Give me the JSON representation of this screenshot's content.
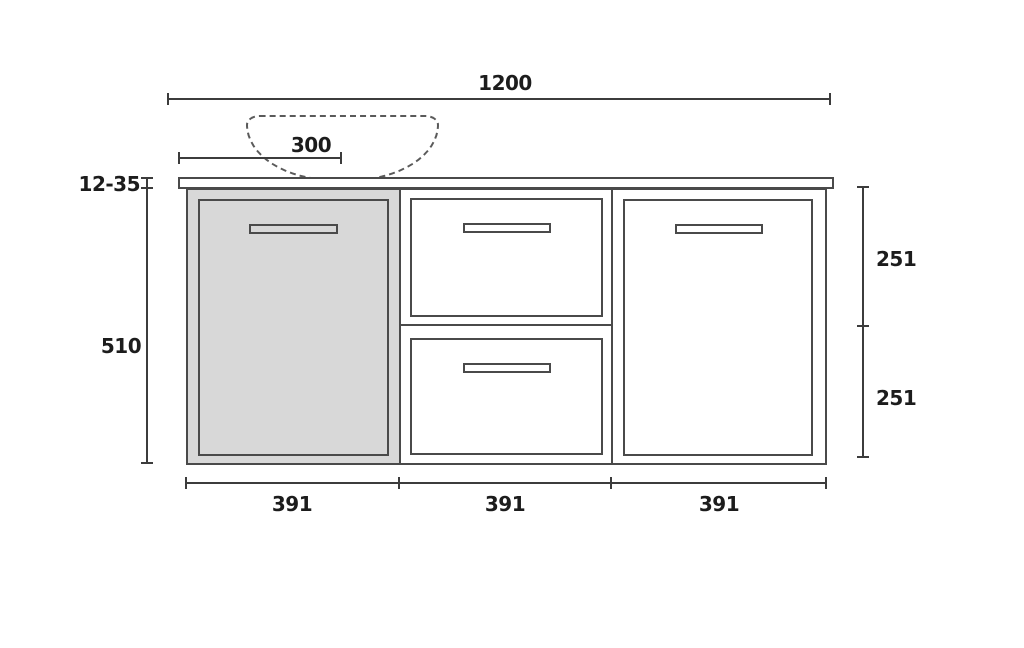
{
  "colors": {
    "background": "#ffffff",
    "stroke": "#4a4a4a",
    "dim_stroke": "#3c3c3c",
    "text": "#1c1c1c",
    "door_fill": "#d8d8d8",
    "panel_fill": "#ffffff",
    "basin_dash": "#5a5a5a"
  },
  "dims": {
    "total_width": "1200",
    "basin_offset": "300",
    "countertop_thickness": "12-35",
    "cabinet_height": "510",
    "right_segments": [
      "251",
      "251"
    ],
    "bottom_segments": [
      "391",
      "391",
      "391"
    ]
  }
}
